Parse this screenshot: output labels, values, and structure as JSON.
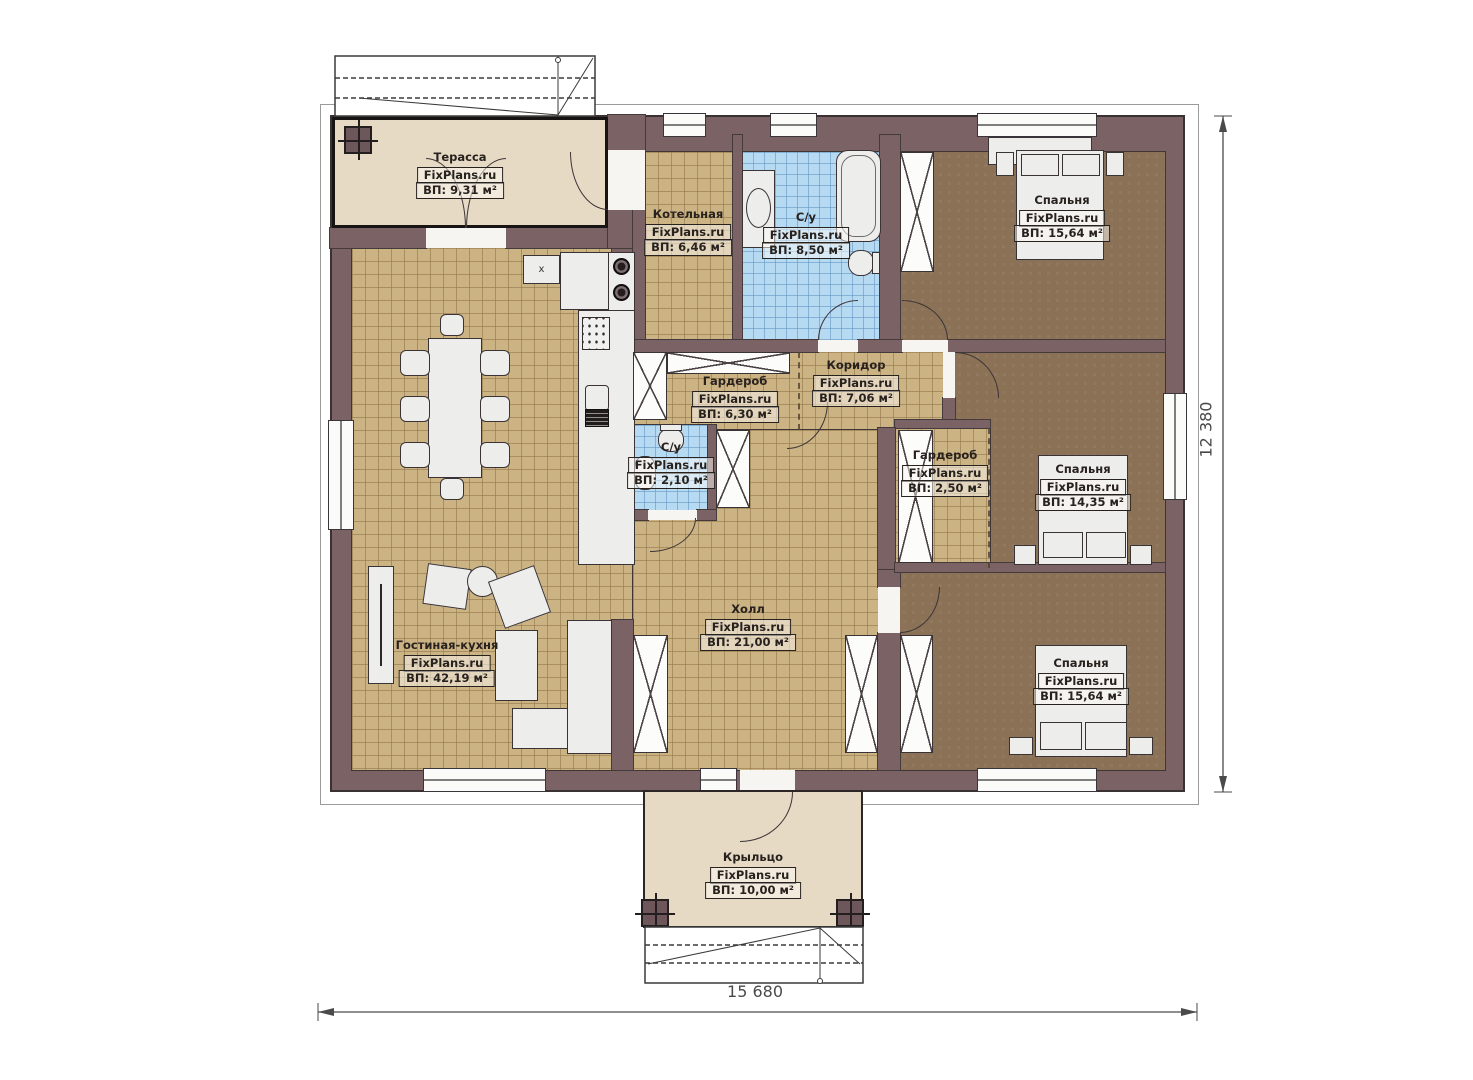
{
  "plan": {
    "brand": "FixPlans.ru",
    "rooms": {
      "terrace": {
        "name": "Терасса",
        "area": "ВП: 9,31 м²"
      },
      "boiler": {
        "name": "Котельная",
        "area": "ВП: 6,46 м²"
      },
      "bathroom_main": {
        "name": "С/у",
        "area": "ВП: 8,50 м²"
      },
      "bedroom_top": {
        "name": "Спальня",
        "area": "ВП: 15,64 м²"
      },
      "wardrobe_main": {
        "name": "Гардероб",
        "area": "ВП: 6,30 м²"
      },
      "corridor": {
        "name": "Коридор",
        "area": "ВП: 7,06 м²"
      },
      "bathroom_small": {
        "name": "С/у",
        "area": "ВП: 2,10 м²"
      },
      "wardrobe_small": {
        "name": "Гардероб",
        "area": "ВП: 2,50 м²"
      },
      "bedroom_middle": {
        "name": "Спальня",
        "area": "ВП: 14,35 м²"
      },
      "hall": {
        "name": "Холл",
        "area": "ВП: 21,00 м²"
      },
      "living_kitchen": {
        "name": "Гостиная-кухня",
        "area": "ВП: 42,19 м²"
      },
      "bedroom_bottom": {
        "name": "Спальня",
        "area": "ВП: 15,64 м²"
      },
      "porch": {
        "name": "Крыльцо",
        "area": "ВП: 10,00 м²"
      }
    },
    "dimensions": {
      "width": "15 680",
      "height": "12 380"
    },
    "kitchen_unit_label": "x",
    "colors": {
      "wall": "#7a6265",
      "floor_tan": "#ccb384",
      "floor_blue": "#b7daf3",
      "floor_brown": "#8b7256",
      "floor_beige": "#e7dac4",
      "outline": "#3a3133"
    }
  }
}
